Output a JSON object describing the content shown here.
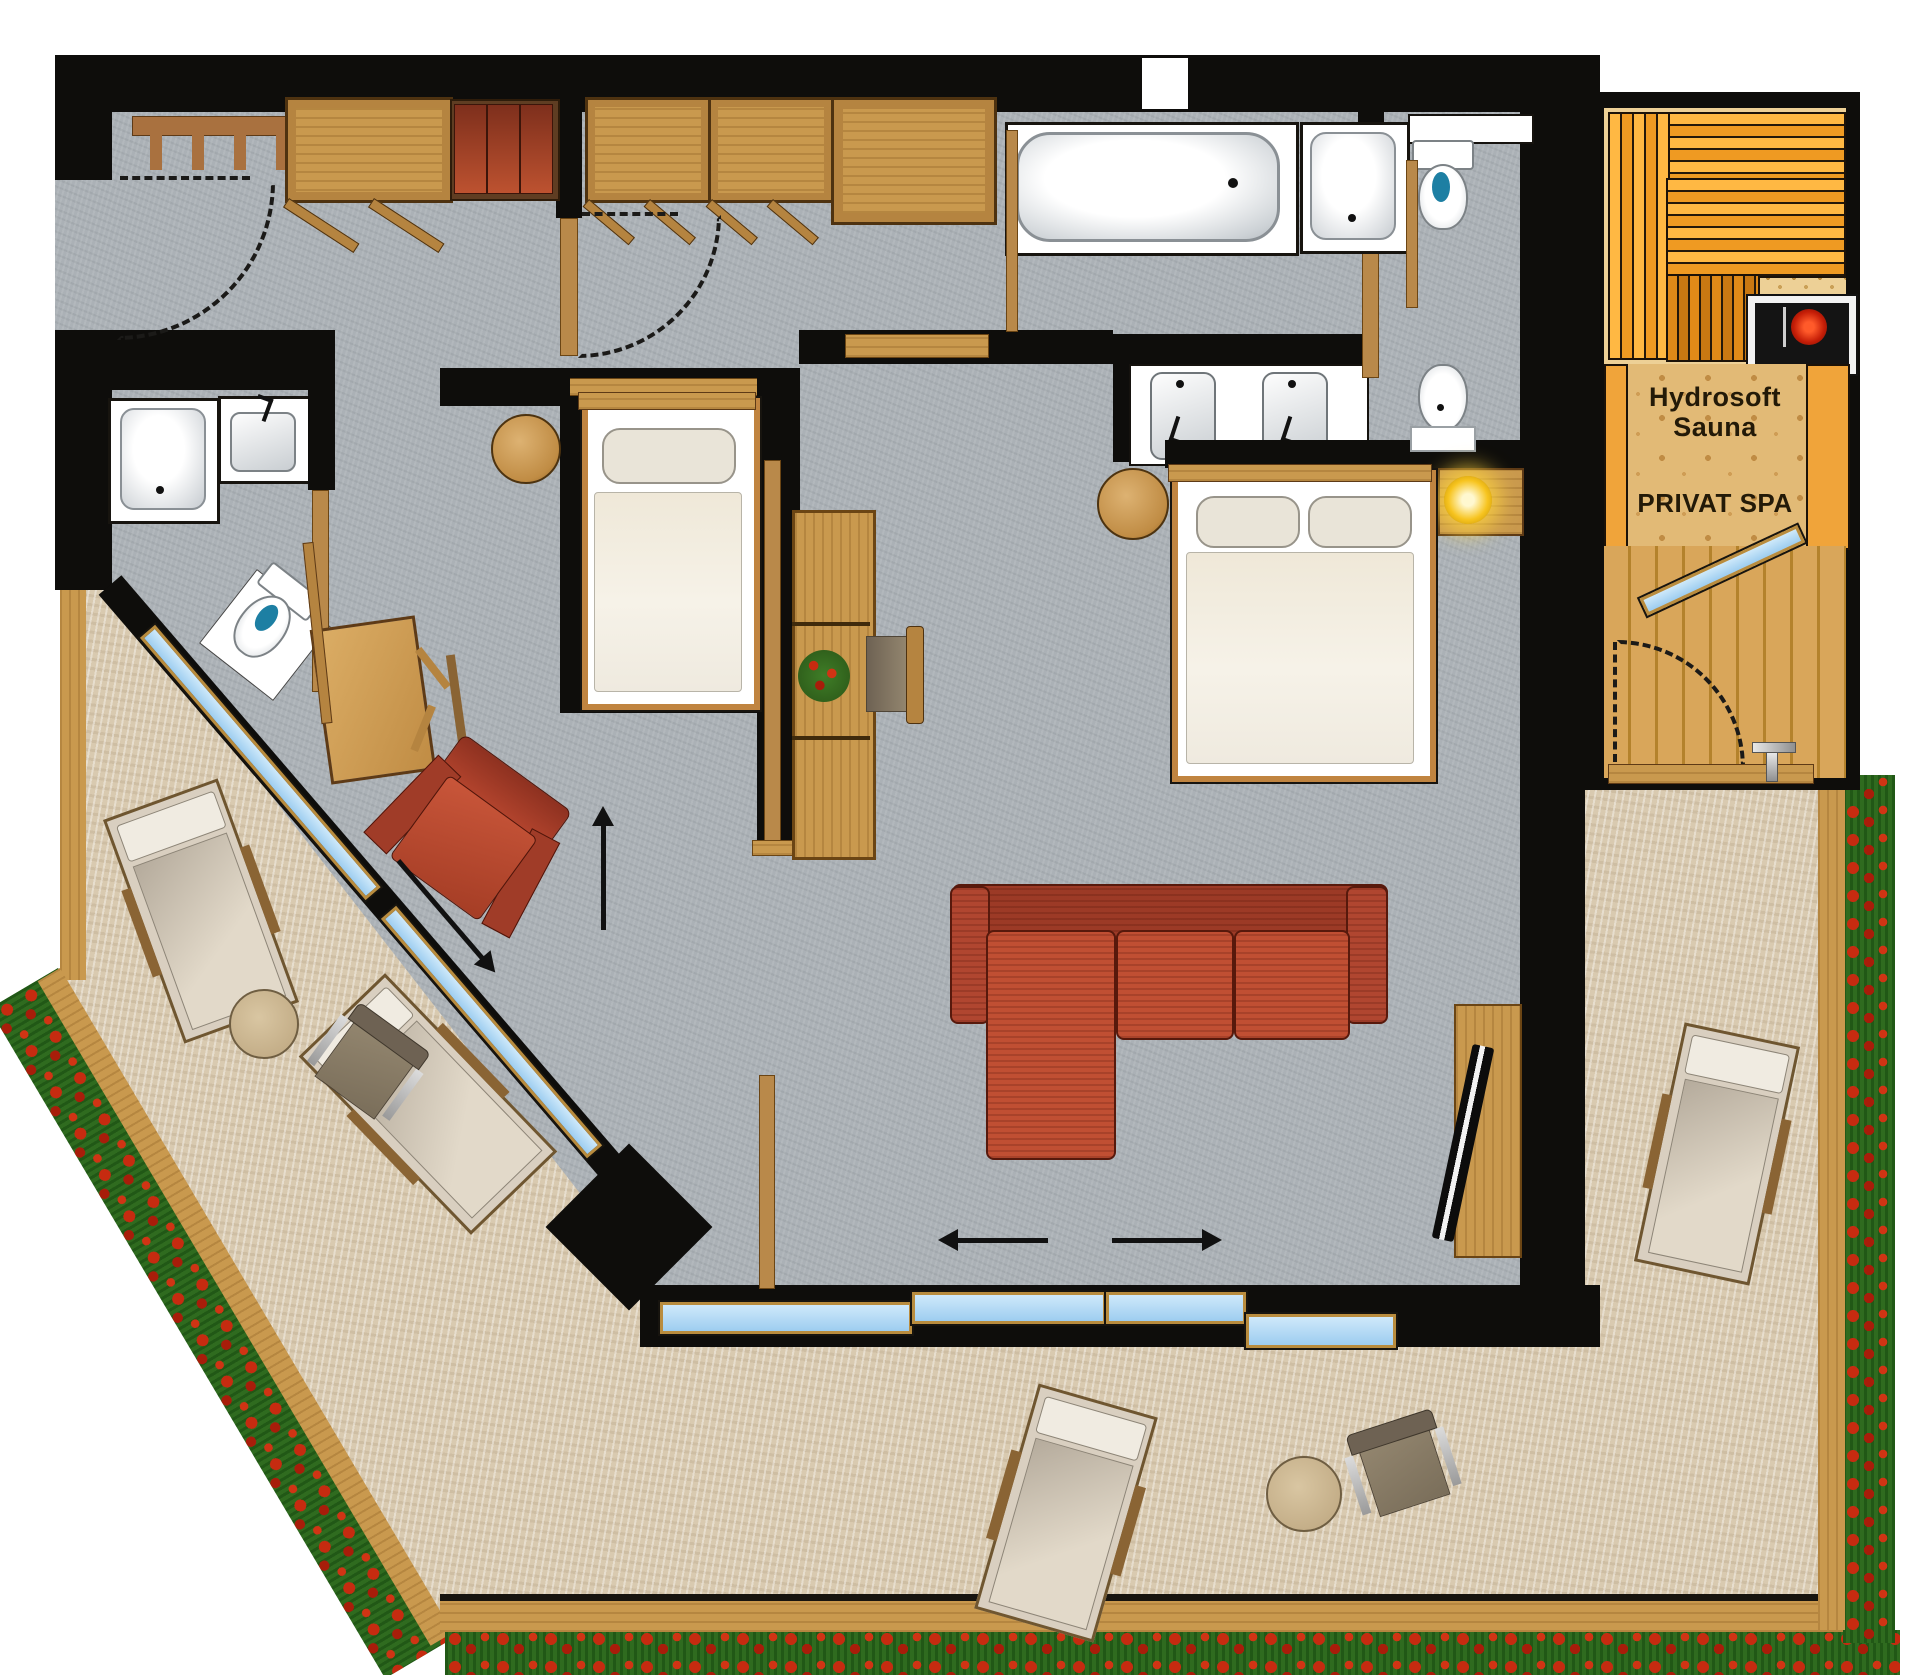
{
  "plan": {
    "type": "hotel-suite-floor-plan",
    "sauna": {
      "label_line1": "Hydrosoft",
      "label_line2": "Sauna"
    },
    "spa": {
      "label": "PRIVAT SPA"
    },
    "colors": {
      "wall": "#0e0d0b",
      "interior_floor": "#abb1b6",
      "terrace_floor": "#d9cab0",
      "terrace_trim": "#c1914b",
      "flower_red": "#c62b10",
      "flower_green": "#2f6b1f",
      "wood": "#c9994e",
      "wood_light": "#dfb070",
      "sauna_bench_orange": "#ef9a22",
      "sauna_floor": "#edd096",
      "pine_floor": "#e2ba76",
      "plank_floor": "#d9a65a",
      "sofa_red": "#c04f33",
      "armchair_red": "#bf4f33",
      "glass_blue": "#a8d4f0",
      "lamp_yellow": "#ffd23e",
      "fixture_white": "#ffffff"
    },
    "fixtures": {
      "entry": [
        "coat-rack",
        "wardrobe",
        "bench-with-red-cushions",
        "entry-door-swing"
      ],
      "small_bathroom": [
        "shower",
        "sink",
        "toilet"
      ],
      "bedroom_single": [
        "single-bed",
        "round-stool",
        "desk",
        "chair",
        "red-armchair",
        "shelf-column",
        "flower-pot"
      ],
      "main_bathroom": [
        "bathtub",
        "shower",
        "double-vanity-sinks",
        "toilet",
        "bidet"
      ],
      "bedroom_double": [
        "double-bed",
        "nightstand",
        "table-lamp",
        "round-stool"
      ],
      "living": [
        "corner-sofa",
        "tv-sideboard",
        "sliding-glass-doors"
      ],
      "spa_area": [
        "sauna-benches",
        "sauna-heater",
        "spa-door-swing"
      ],
      "terrace": [
        "sun-lounger",
        "sun-lounger",
        "sun-lounger",
        "sun-lounger",
        "round-table",
        "round-table",
        "terrace-chair",
        "terrace-chair",
        "flower-border"
      ]
    }
  }
}
